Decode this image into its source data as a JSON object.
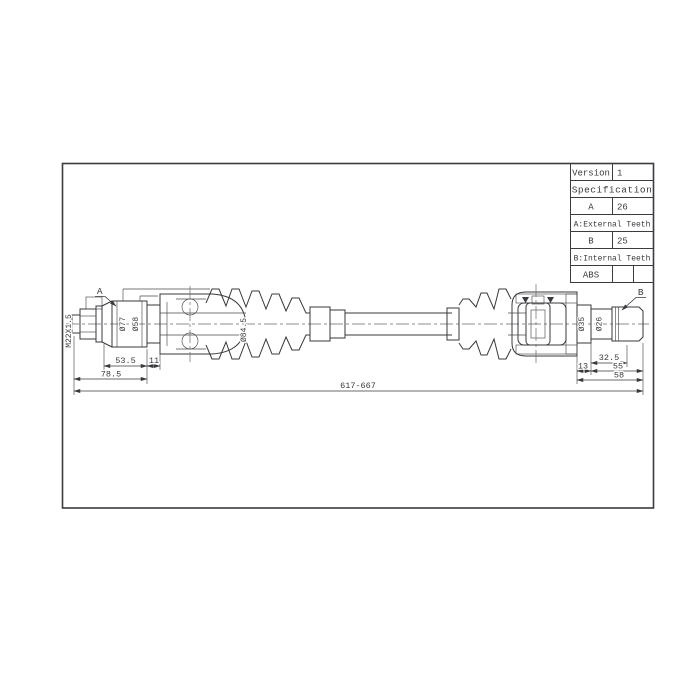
{
  "spec_table": {
    "version_label": "Version",
    "version_value": "1",
    "spec_header": "Specification",
    "row_a_label": "A",
    "row_a_value": "26",
    "note_a": "A:External Teeth",
    "row_b_label": "B",
    "row_b_value": "25",
    "note_b": "B:Internal Teeth",
    "abs_label": "ABS"
  },
  "callouts": {
    "joint_a": "A",
    "joint_b": "B",
    "thread_spec": "M22X1.5"
  },
  "diameters": {
    "outer_joint_flange": "Ø77",
    "outer_joint_neck": "Ø58",
    "outer_boot": "Ø84.5",
    "inner_joint_disc": "Ø35",
    "inner_stub": "Ø26"
  },
  "dimensions": {
    "outer_stub_length": "53.5",
    "outer_step_length": "11",
    "outer_total_length": "78.5",
    "overall_length": "617-667",
    "inner_step_length": "13",
    "inner_spline_length": "32.5",
    "inner_stub_length": "55",
    "inner_total_length": "58"
  },
  "colors": {
    "line": "#38383c",
    "background": "#ffffff"
  }
}
